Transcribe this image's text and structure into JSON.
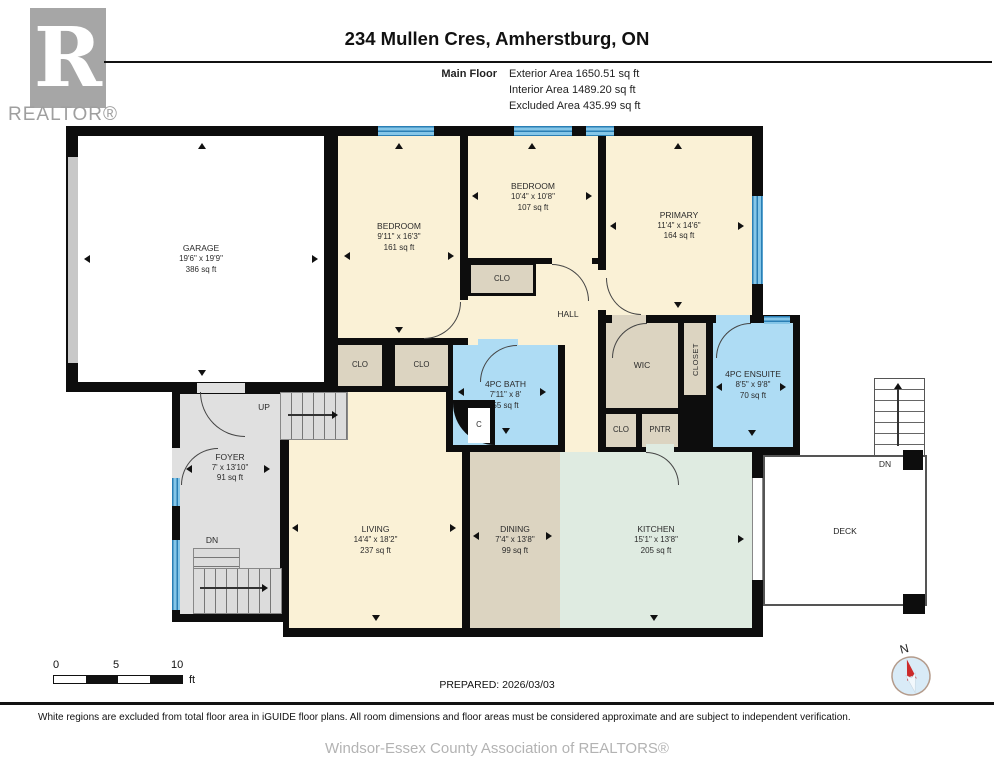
{
  "header": {
    "logo_letter": "R",
    "logo_label": "REALTOR®",
    "title": "234 Mullen Cres, Amherstburg, ON",
    "floor_label": "Main Floor",
    "stats": [
      "Exterior Area 1650.51 sq ft",
      "Interior Area 1489.20 sq ft",
      "Excluded Area 435.99 sq ft"
    ]
  },
  "rooms": {
    "garage": {
      "name": "GARAGE",
      "dims": "19'6\" x 19'9\"",
      "area": "386 sq ft"
    },
    "bedroom_left": {
      "name": "BEDROOM",
      "dims": "9'11\" x 16'3\"",
      "area": "161 sq ft"
    },
    "bedroom_mid": {
      "name": "BEDROOM",
      "dims": "10'4\" x 10'8\"",
      "area": "107 sq ft"
    },
    "primary": {
      "name": "PRIMARY",
      "dims": "11'4\" x 14'6\"",
      "area": "164 sq ft"
    },
    "hall": {
      "name": "HALL"
    },
    "clo_hall": {
      "name": "CLO"
    },
    "clo_left1": {
      "name": "CLO"
    },
    "clo_left2": {
      "name": "CLO"
    },
    "wic": {
      "name": "WIC"
    },
    "closet": {
      "name": "CLOSET"
    },
    "ensuite": {
      "name": "4PC ENSUITE",
      "dims": "8'5\" x 9'8\"",
      "area": "70 sq ft"
    },
    "bath": {
      "name": "4PC BATH",
      "dims": "7'11\" x 8'",
      "area": "55 sq ft"
    },
    "c_closet": {
      "name": "C"
    },
    "clo_small": {
      "name": "CLO"
    },
    "pntr": {
      "name": "PNTR"
    },
    "foyer": {
      "name": "FOYER",
      "dims": "7' x 13'10\"",
      "area": "91 sq ft"
    },
    "living": {
      "name": "LIVING",
      "dims": "14'4\" x 18'2\"",
      "area": "237 sq ft"
    },
    "dining": {
      "name": "DINING",
      "dims": "7'4\" x 13'8\"",
      "area": "99 sq ft"
    },
    "kitchen": {
      "name": "KITCHEN",
      "dims": "15'1\" x 13'8\"",
      "area": "205 sq ft"
    },
    "deck": {
      "name": "DECK"
    }
  },
  "stairs": {
    "up_label": "UP",
    "dn_label": "DN",
    "deck_dn_label": "DN"
  },
  "scale_bar": {
    "ticks": [
      "0",
      "5",
      "10"
    ],
    "unit": "ft"
  },
  "prepared": "PREPARED: 2026/03/03",
  "compass_label": "N",
  "footer": {
    "disclaimer": "White regions are excluded from total floor area in iGUIDE floor plans. All room dimensions and floor areas must be considered approximate and are subject to independent verification.",
    "attribution": "Windsor-Essex County Association of REALTORS®"
  },
  "colors": {
    "wall": "#0d0d0d",
    "room_cream": "#FAF1D6",
    "closet_tan": "#DCD4C1",
    "bath_blue": "#AEDCF4",
    "kitchen_mint": "#DFEBE1",
    "excluded_grey": "#E0E0E0",
    "window_blue": "#2A7FB5",
    "compass_red": "#CC2A2A",
    "logo_grey": "#A6A6A6"
  }
}
